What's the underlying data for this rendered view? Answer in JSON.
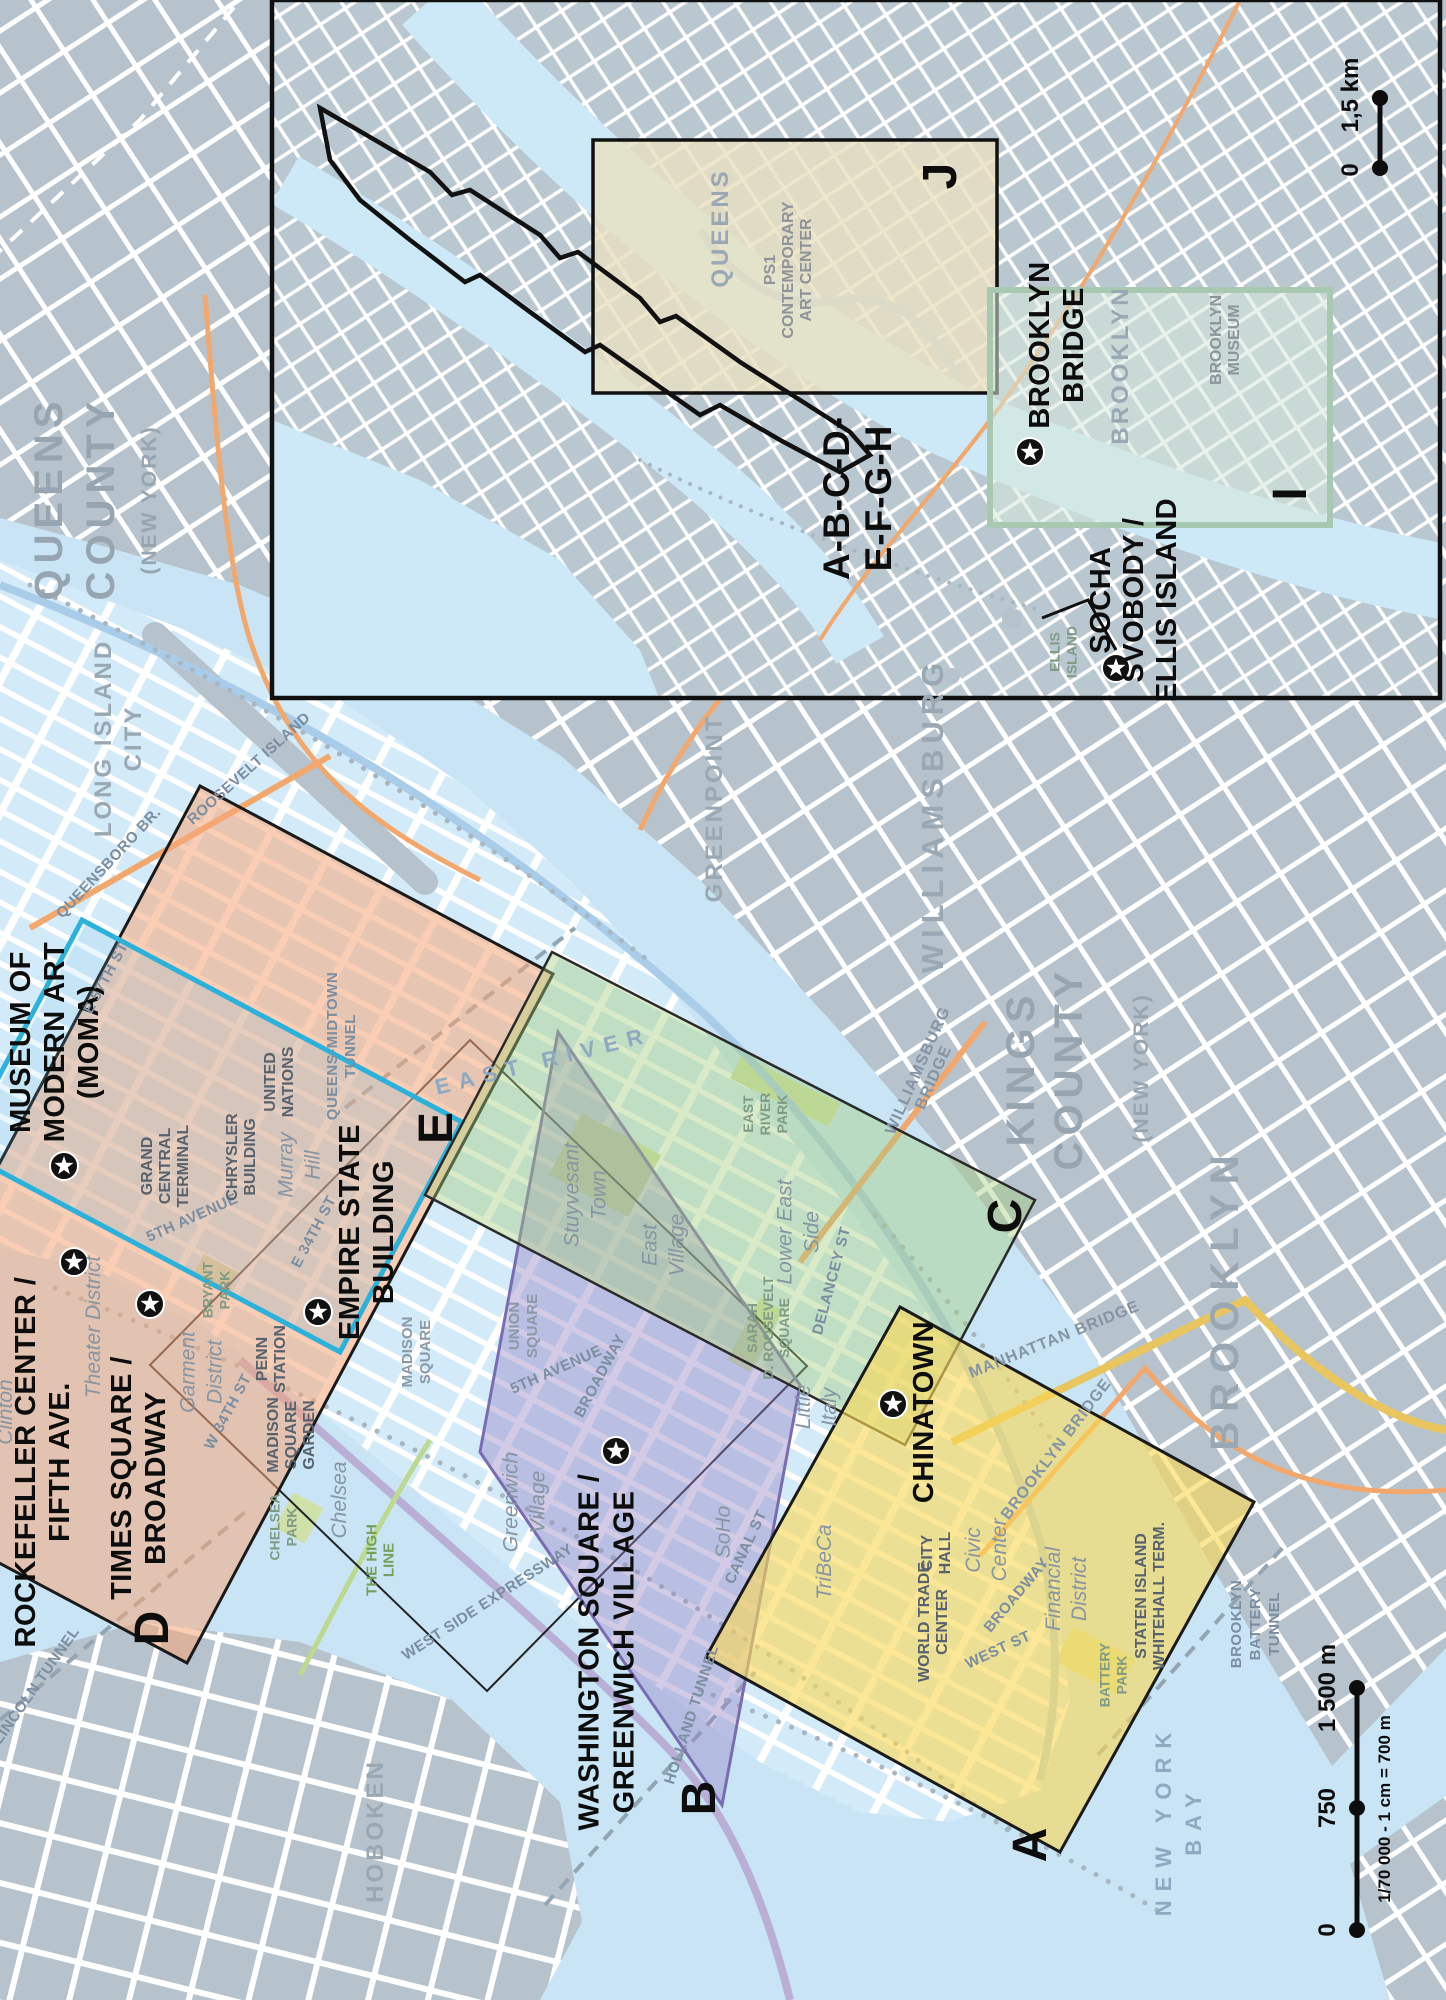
{
  "title": "New York City guide map with page-index rectangles",
  "colors": {
    "water": "#c9e5f5",
    "land": "#b6c3cc",
    "manhattan": "#d3eaf8",
    "region_a_yellow": "#fad754",
    "region_b_purple": "#9684c3",
    "region_c_green": "#a5cd7d",
    "region_d_salmon": "#f4a679",
    "region_e_cyan": "#2cb2da",
    "region_j_tan": "#e9e0c1",
    "region_i_sage": "#a9c8b2",
    "road_orange": "#f2a76d",
    "star": "#111111"
  },
  "index_letters": [
    {
      "ch": "A",
      "x": 1046,
      "y": 1845
    },
    {
      "ch": "B",
      "x": 715,
      "y": 1798
    },
    {
      "ch": "C",
      "x": 1021,
      "y": 1216
    },
    {
      "ch": "D",
      "x": 168,
      "y": 1628
    },
    {
      "ch": "E",
      "x": 452,
      "y": 1128
    },
    {
      "ch": "I",
      "x": 1306,
      "y": 494
    },
    {
      "ch": "J",
      "x": 956,
      "y": 176
    }
  ],
  "stars": [
    {
      "name": "moma-star",
      "x": 64,
      "y": 1166
    },
    {
      "name": "rockefeller-star",
      "x": 74,
      "y": 1262
    },
    {
      "name": "times-square-star",
      "x": 150,
      "y": 1304
    },
    {
      "name": "empire-state-star",
      "x": 318,
      "y": 1312
    },
    {
      "name": "washington-square-star",
      "x": 616,
      "y": 1451
    },
    {
      "name": "chinatown-star",
      "x": 893,
      "y": 1404
    },
    {
      "name": "brooklyn-bridge-star",
      "x": 1030,
      "y": 452
    },
    {
      "name": "socha-svobody-star",
      "x": 1116,
      "y": 668
    }
  ],
  "labels": [
    {
      "n": "moma",
      "l": [
        "MUSEUM OF",
        "MODERN ART",
        "(MOMA)"
      ],
      "x": 64,
      "y": 1042,
      "c": "poi",
      "lh": 34
    },
    {
      "n": "rockefeller-center",
      "l": [
        "ROCKEFELLER CENTER /",
        "FIFTH AVE."
      ],
      "x": 52,
      "y": 1462,
      "c": "poi",
      "lh": 34
    },
    {
      "n": "times-square",
      "l": [
        "TIMES SQUARE /",
        "BROADWAY"
      ],
      "x": 148,
      "y": 1478,
      "c": "poi",
      "lh": 34
    },
    {
      "n": "empire-state-building",
      "l": [
        "EMPIRE STATE",
        "BUILDING"
      ],
      "x": 376,
      "y": 1232,
      "c": "poi",
      "lh": 34
    },
    {
      "n": "washington-square",
      "l": [
        "WASHINGTON SQUARE /",
        "GREENWICH VILLAGE"
      ],
      "x": 616,
      "y": 1652,
      "c": "poi",
      "lh": 35
    },
    {
      "n": "chinatown",
      "l": [
        "CHINATOWN"
      ],
      "x": 933,
      "y": 1412,
      "c": "poi"
    },
    {
      "n": "brooklyn-bridge-poi",
      "l": [
        "BROOKLYN",
        "BRIDGE"
      ],
      "x": 1066,
      "y": 345,
      "c": "poi",
      "lh": 34
    },
    {
      "n": "socha-svobody-ellis-island",
      "l": [
        "SOCHA",
        "SVOBODY /",
        "ELLIS ISLAND"
      ],
      "x": 1143,
      "y": 600,
      "c": "poi",
      "lh": 33
    },
    {
      "n": "page-range",
      "l": [
        "A-B-C-D-",
        "E-F-G-H"
      ],
      "x": 870,
      "y": 498,
      "c": "poi-xl",
      "lh": 42
    },
    {
      "n": "queens-county",
      "l": [
        "QUEENS",
        "COUNTY"
      ],
      "x": 88,
      "y": 498,
      "c": "county",
      "lh": 52
    },
    {
      "n": "queens-county-sub",
      "l": [
        "(NEW YORK)"
      ],
      "x": 156,
      "y": 500,
      "c": "county-sub"
    },
    {
      "n": "kings-county",
      "l": [
        "KINGS",
        "COUNTY"
      ],
      "x": 1058,
      "y": 1068,
      "c": "county",
      "lh": 48
    },
    {
      "n": "kings-county-sub",
      "l": [
        "(NEW YORK)"
      ],
      "x": 1148,
      "y": 1068,
      "c": "county-sub"
    },
    {
      "n": "brooklyn-borough",
      "l": [
        "BROOKLYN"
      ],
      "x": 1238,
      "y": 1298,
      "c": "borough"
    },
    {
      "n": "williamsburg",
      "l": [
        "WILLIAMSBURG"
      ],
      "x": 943,
      "y": 815,
      "c": "area-lg"
    },
    {
      "n": "greenpoint",
      "l": [
        "GREENPOINT"
      ],
      "x": 722,
      "y": 808,
      "c": "area-md"
    },
    {
      "n": "long-island-city",
      "l": [
        "LONG ISLAND",
        "CITY"
      ],
      "x": 126,
      "y": 738,
      "c": "area-md",
      "lh": 30
    },
    {
      "n": "hoboken",
      "l": [
        "HOBOKEN"
      ],
      "x": 383,
      "y": 1831,
      "c": "area-md"
    },
    {
      "n": "brooklyn-inset",
      "l": [
        "BROOKLYN"
      ],
      "x": 1128,
      "y": 365,
      "c": "area-md"
    },
    {
      "n": "queens-inset",
      "l": [
        "QUEENS"
      ],
      "x": 728,
      "y": 228,
      "c": "area-md"
    },
    {
      "n": "new-york-bay",
      "l": [
        "NEW YORK",
        "BAY"
      ],
      "x": 1186,
      "y": 1820,
      "c": "water",
      "lh": 30
    },
    {
      "n": "east-river",
      "l": [
        "EAST RIVER"
      ],
      "x": 545,
      "y": 1068,
      "c": "water",
      "rot": -14
    },
    {
      "n": "queensboro-br",
      "l": [
        "QUEENSBORO BR."
      ],
      "x": 112,
      "y": 866,
      "c": "st",
      "rot": -47
    },
    {
      "n": "roosevelt-island",
      "l": [
        "ROOSEVELT ISLAND"
      ],
      "x": 252,
      "y": 772,
      "c": "st",
      "rot": -42
    },
    {
      "n": "queens-midtown-tunnel",
      "l": [
        "QUEENS-MIDTOWN",
        "TUNNEL"
      ],
      "x": 346,
      "y": 1046,
      "c": "st",
      "lh": 18
    },
    {
      "n": "lincoln-tunnel",
      "l": [
        "LINCOLN TUNNEL"
      ],
      "x": 40,
      "y": 1688,
      "c": "st",
      "rot": -55
    },
    {
      "n": "holland-tunnel",
      "l": [
        "HOLLAND TUNNEL"
      ],
      "x": 696,
      "y": 1716,
      "c": "st",
      "rot": -72
    },
    {
      "n": "fifth-avenue-mid",
      "l": [
        "5TH AVENUE"
      ],
      "x": 194,
      "y": 1222,
      "c": "st",
      "rot": -24
    },
    {
      "n": "fifth-avenue-low",
      "l": [
        "5TH AVENUE"
      ],
      "x": 558,
      "y": 1374,
      "c": "st",
      "rot": -24
    },
    {
      "n": "e-34th-st",
      "l": [
        "E 34TH ST"
      ],
      "x": 318,
      "y": 1234,
      "c": "st",
      "rot": -62
    },
    {
      "n": "w-34th-st",
      "l": [
        "W 34TH ST"
      ],
      "x": 232,
      "y": 1414,
      "c": "st",
      "rot": -62
    },
    {
      "n": "e-57th-st",
      "l": [
        "E 57TH ST"
      ],
      "x": 110,
      "y": 980,
      "c": "st",
      "rot": -62
    },
    {
      "n": "broadway-mid",
      "l": [
        "BROADWAY"
      ],
      "x": 604,
      "y": 1378,
      "c": "st",
      "rot": -62
    },
    {
      "n": "broadway-low",
      "l": [
        "BROADWAY"
      ],
      "x": 1020,
      "y": 1598,
      "c": "st",
      "rot": -50
    },
    {
      "n": "west-st",
      "l": [
        "WEST ST"
      ],
      "x": 1000,
      "y": 1654,
      "c": "st",
      "rot": -25
    },
    {
      "n": "canal-st",
      "l": [
        "CANAL ST"
      ],
      "x": 750,
      "y": 1549,
      "c": "st",
      "rot": -65
    },
    {
      "n": "delancey-st",
      "l": [
        "DELANCEY ST"
      ],
      "x": 836,
      "y": 1282,
      "c": "st",
      "rot": -75
    },
    {
      "n": "west-side-expressway",
      "l": [
        "WEST SIDE EXPRESSWAY"
      ],
      "x": 490,
      "y": 1606,
      "c": "st",
      "rot": -33
    },
    {
      "n": "manhattan-bridge",
      "l": [
        "MANHATTAN BRIDGE"
      ],
      "x": 1056,
      "y": 1344,
      "c": "st2",
      "rot": -22
    },
    {
      "n": "brooklyn-bridge-road",
      "l": [
        "BROOKLYN BRIDGE"
      ],
      "x": 1060,
      "y": 1452,
      "c": "st2",
      "rot": -53
    },
    {
      "n": "williamsburg-bridge",
      "l": [
        "WILLIAMSBURG",
        "BRIDGE"
      ],
      "x": 930,
      "y": 1076,
      "c": "st2",
      "rot": -66,
      "lh": 17
    },
    {
      "n": "brooklyn-battery-tunnel",
      "l": [
        "BROOKLYN",
        "BATTERY",
        "TUNNEL"
      ],
      "x": 1260,
      "y": 1624,
      "c": "st",
      "lh": 19
    },
    {
      "n": "grand-central-terminal",
      "l": [
        "GRAND",
        "CENTRAL",
        "TERMINAL"
      ],
      "x": 170,
      "y": 1166,
      "c": "bld",
      "lh": 18
    },
    {
      "n": "chrysler-building",
      "l": [
        "CHRYSLER",
        "BUILDING"
      ],
      "x": 246,
      "y": 1157,
      "c": "bld",
      "lh": 18
    },
    {
      "n": "united-nations",
      "l": [
        "UNITED",
        "NATIONS"
      ],
      "x": 284,
      "y": 1082,
      "c": "bld",
      "lh": 18
    },
    {
      "n": "penn-station",
      "l": [
        "PENN",
        "STATION"
      ],
      "x": 276,
      "y": 1359,
      "c": "bld",
      "lh": 18
    },
    {
      "n": "madison-square-garden",
      "l": [
        "MADISON",
        "SQUARE",
        "GARDEN"
      ],
      "x": 296,
      "y": 1435,
      "c": "bld",
      "lh": 18
    },
    {
      "n": "city-hall",
      "l": [
        "CITY",
        "HALL"
      ],
      "x": 941,
      "y": 1553,
      "c": "bld",
      "lh": 18
    },
    {
      "n": "world-trade-center",
      "l": [
        "WORLD TRADE",
        "CENTER"
      ],
      "x": 938,
      "y": 1622,
      "c": "bld",
      "lh": 18
    },
    {
      "n": "staten-island-whitehall-term",
      "l": [
        "STATEN ISLAND",
        "WHITEHALL TERM."
      ],
      "x": 1155,
      "y": 1596,
      "c": "bld",
      "lh": 18
    },
    {
      "n": "ps1-contemporary-art-center",
      "l": [
        "PS1",
        "CONTEMPORARY",
        "ART CENTER"
      ],
      "x": 793,
      "y": 270,
      "c": "bld-gray",
      "lh": 18
    },
    {
      "n": "brooklyn-museum",
      "l": [
        "BROOKLYN",
        "MUSEUM"
      ],
      "x": 1230,
      "y": 340,
      "c": "bld-gray",
      "lh": 18
    },
    {
      "n": "madison-square",
      "l": [
        "MADISON",
        "SQUARE"
      ],
      "x": 421,
      "y": 1352,
      "c": "sq",
      "lh": 18
    },
    {
      "n": "union-square",
      "l": [
        "UNION",
        "SQUARE"
      ],
      "x": 528,
      "y": 1326,
      "c": "sq",
      "lh": 18
    },
    {
      "n": "east-river-park",
      "l": [
        "EAST",
        "RIVER",
        "PARK"
      ],
      "x": 770,
      "y": 1114,
      "c": "park",
      "lh": 17
    },
    {
      "n": "sarah-d-roosevelt-square",
      "l": [
        "SARAH",
        "D. ROOSEVELT",
        "SQUARE"
      ],
      "x": 773,
      "y": 1328,
      "c": "park",
      "lh": 16
    },
    {
      "n": "bryant-park",
      "l": [
        "BRYANT",
        "PARK"
      ],
      "x": 221,
      "y": 1290,
      "c": "park",
      "lh": 17
    },
    {
      "n": "chelsea-park",
      "l": [
        "CHELSEA",
        "PARK"
      ],
      "x": 288,
      "y": 1527,
      "c": "park",
      "lh": 17
    },
    {
      "n": "battery-park",
      "l": [
        "BATTERY",
        "PARK"
      ],
      "x": 1118,
      "y": 1675,
      "c": "park",
      "lh": 17
    },
    {
      "n": "the-high-line",
      "l": [
        "THE HIGH",
        "LINE"
      ],
      "x": 385,
      "y": 1560,
      "c": "hl",
      "lh": 17
    },
    {
      "n": "ellis-island",
      "l": [
        "ELLIS",
        "ISLAND"
      ],
      "x": 1068,
      "y": 652,
      "c": "park",
      "lh": 17
    },
    {
      "n": "theater-district",
      "l": [
        "Theater District"
      ],
      "x": 100,
      "y": 1327,
      "c": "dist"
    },
    {
      "n": "garment-district",
      "l": [
        "Garment",
        "District"
      ],
      "x": 208,
      "y": 1372,
      "c": "dist",
      "lh": 27
    },
    {
      "n": "clinton",
      "l": [
        "Clinton"
      ],
      "x": 12,
      "y": 1412,
      "c": "dist"
    },
    {
      "n": "murray-hill",
      "l": [
        "Murray",
        "Hill"
      ],
      "x": 306,
      "y": 1165,
      "c": "dist",
      "lh": 27
    },
    {
      "n": "chelsea",
      "l": [
        "Chelsea"
      ],
      "x": 346,
      "y": 1500,
      "c": "dist"
    },
    {
      "n": "greenwich-village",
      "l": [
        "Greenwich",
        "Village"
      ],
      "x": 531,
      "y": 1502,
      "c": "dist",
      "lh": 27
    },
    {
      "n": "stuyvesant-town",
      "l": [
        "Stuyvesant",
        "Town"
      ],
      "x": 592,
      "y": 1195,
      "c": "dist",
      "lh": 27
    },
    {
      "n": "east-village",
      "l": [
        "East",
        "Village"
      ],
      "x": 670,
      "y": 1245,
      "c": "dist",
      "lh": 27
    },
    {
      "n": "lower-east-side",
      "l": [
        "Lower East",
        "Side"
      ],
      "x": 805,
      "y": 1232,
      "c": "dist",
      "lh": 27
    },
    {
      "n": "little-italy",
      "l": [
        "Little",
        "Italy"
      ],
      "x": 823,
      "y": 1407,
      "c": "dist",
      "lh": 26
    },
    {
      "n": "soho",
      "l": [
        "SoHo"
      ],
      "x": 730,
      "y": 1532,
      "c": "dist"
    },
    {
      "n": "tribeca",
      "l": [
        "TriBeCa"
      ],
      "x": 831,
      "y": 1562,
      "c": "dist"
    },
    {
      "n": "civic-center",
      "l": [
        "Civic",
        "Center"
      ],
      "x": 993,
      "y": 1550,
      "c": "dist",
      "lh": 26
    },
    {
      "n": "financial-district",
      "l": [
        "Financial",
        "District"
      ],
      "x": 1073,
      "y": 1589,
      "c": "dist",
      "lh": 26
    }
  ],
  "scale_bars": {
    "main": {
      "ticks": [
        {
          "t": "0",
          "y": 1930
        },
        {
          "t": "750",
          "y": 1808
        },
        {
          "t": "1 500 m",
          "y": 1688
        }
      ],
      "x": 1357,
      "y1": 1688,
      "y2": 1930,
      "note": "1/70 000 - 1 cm = 700 m"
    },
    "inset": {
      "ticks": [
        {
          "t": "0",
          "y": 170
        },
        {
          "t": "1,5 km",
          "y": 95
        }
      ],
      "x": 1380,
      "y1": 98,
      "y2": 168
    }
  }
}
